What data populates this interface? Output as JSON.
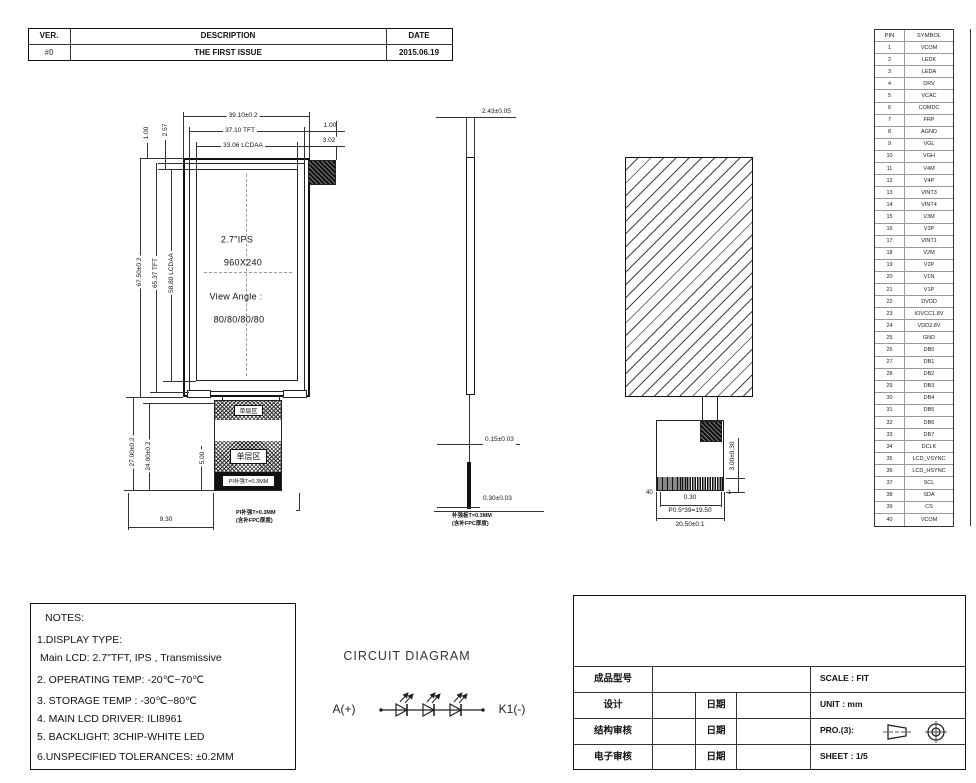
{
  "revision_table": {
    "headers": [
      "VER.",
      "DESCRIPTION",
      "DATE"
    ],
    "rows": [
      [
        "#0",
        "THE FIRST ISSUE",
        "2015.06.19"
      ]
    ]
  },
  "pin_table": {
    "headers": {
      "pin": "PIN",
      "symbol": "SYMBOL"
    },
    "rows": [
      {
        "pin": "1",
        "symbol": "VCOM"
      },
      {
        "pin": "2",
        "symbol": "LEDK"
      },
      {
        "pin": "3",
        "symbol": "LEDA"
      },
      {
        "pin": "4",
        "symbol": "DRV"
      },
      {
        "pin": "5",
        "symbol": "VCAC"
      },
      {
        "pin": "6",
        "symbol": "COMDC"
      },
      {
        "pin": "7",
        "symbol": "FRP"
      },
      {
        "pin": "8",
        "symbol": "AGND"
      },
      {
        "pin": "9",
        "symbol": "VGL"
      },
      {
        "pin": "10",
        "symbol": "VGH"
      },
      {
        "pin": "11",
        "symbol": "V4M"
      },
      {
        "pin": "12",
        "symbol": "V4P"
      },
      {
        "pin": "13",
        "symbol": "VINT3"
      },
      {
        "pin": "14",
        "symbol": "VINT4"
      },
      {
        "pin": "15",
        "symbol": "V3M"
      },
      {
        "pin": "16",
        "symbol": "V3P"
      },
      {
        "pin": "17",
        "symbol": "VINT1"
      },
      {
        "pin": "18",
        "symbol": "V2M"
      },
      {
        "pin": "19",
        "symbol": "V2P"
      },
      {
        "pin": "20",
        "symbol": "V1N"
      },
      {
        "pin": "21",
        "symbol": "V1P"
      },
      {
        "pin": "22",
        "symbol": "DVDD"
      },
      {
        "pin": "23",
        "symbol": "IOVCC1.8V"
      },
      {
        "pin": "24",
        "symbol": "VDD2.8V"
      },
      {
        "pin": "25",
        "symbol": "GND"
      },
      {
        "pin": "26",
        "symbol": "DB0"
      },
      {
        "pin": "27",
        "symbol": "DB1"
      },
      {
        "pin": "28",
        "symbol": "DB2"
      },
      {
        "pin": "29",
        "symbol": "DB3"
      },
      {
        "pin": "30",
        "symbol": "DB4"
      },
      {
        "pin": "31",
        "symbol": "DB5"
      },
      {
        "pin": "32",
        "symbol": "DB6"
      },
      {
        "pin": "33",
        "symbol": "DB7"
      },
      {
        "pin": "34",
        "symbol": "DCLK"
      },
      {
        "pin": "35",
        "symbol": "LCD_VSYNC"
      },
      {
        "pin": "36",
        "symbol": "LCD_HSYNC"
      },
      {
        "pin": "37",
        "symbol": "SCL"
      },
      {
        "pin": "38",
        "symbol": "SDA"
      },
      {
        "pin": "39",
        "symbol": "CS"
      },
      {
        "pin": "40",
        "symbol": "VCOM"
      }
    ]
  },
  "front_view": {
    "panel_text": {
      "line1": "2.7\"IPS",
      "line2": "960X240",
      "line3": "View Angle :",
      "line4": "80/80/80/80"
    },
    "dims": {
      "width_outer": "39.10±0.2",
      "width_tft": "37.10 TFT",
      "width_aa": "33.06 LCDAA",
      "right_top": "1.00",
      "right_aa": "3.02",
      "left_top_1": "1.00",
      "left_top_2": "2.57",
      "height_outer": "67.50±0.2",
      "height_tft": "65.37 TFT",
      "height_aa": "58.80 LCDAA",
      "fpc_len_outer": "27.00±0.2",
      "fpc_len_inner": "24.00±0.2",
      "stiffener_len": "5.00",
      "fpc_offset": "9.30"
    },
    "fpc": {
      "zone1": "单层区",
      "zone2": "单层区",
      "stiffener_label": "PI补强T=0.3MM",
      "note_line1": "PI补强T=0.3MM",
      "note_line2": "(含补FPC厚度)"
    }
  },
  "side_view": {
    "dims": {
      "thickness": "2.43±0.05",
      "fpc_thickness": "0.15±0.03",
      "stiffener_thickness": "0.30±0.03"
    },
    "note_line1": "补强板T=0.3MM",
    "note_line2": "(含补FPC厚度)"
  },
  "back_view": {
    "pin_last": "40",
    "pin_first": "1",
    "dims": {
      "pitch": "0.30",
      "pitch_total": "P0.5*39=19.50",
      "fpc_width": "20.50±0.1",
      "contact_height": "3.00±0.30"
    }
  },
  "circuit": {
    "title": "CIRCUIT DIAGRAM",
    "anode": "A(+)",
    "cathode": "K1(-)"
  },
  "notes": {
    "lines": [
      "NOTES:",
      "1.DISPLAY TYPE:",
      "Main LCD: 2.7\"TFT, IPS , Transmissive",
      "2. OPERATING TEMP: -20℃~70℃",
      "3. STORAGE TEMP : -30℃~80℃",
      "4. MAIN LCD DRIVER: ILI8961",
      "5. BACKLIGHT: 3CHIP-WHITE LED",
      "6.UNSPECIFIED TOLERANCES: ±0.2MM"
    ]
  },
  "title_block": {
    "model_label": "成品型号",
    "scale": "SCALE : FIT",
    "unit": "UNIT : mm",
    "projection": "PRO.(3):",
    "sheet": "SHEET : 1/5",
    "rows": [
      {
        "label": "设计",
        "date": "日期"
      },
      {
        "label": "结构审核",
        "date": "日期"
      },
      {
        "label": "电子审核",
        "date": "日期"
      }
    ]
  },
  "colors": {
    "line": "#333333",
    "ink": "#111111",
    "bg": "#ffffff"
  }
}
